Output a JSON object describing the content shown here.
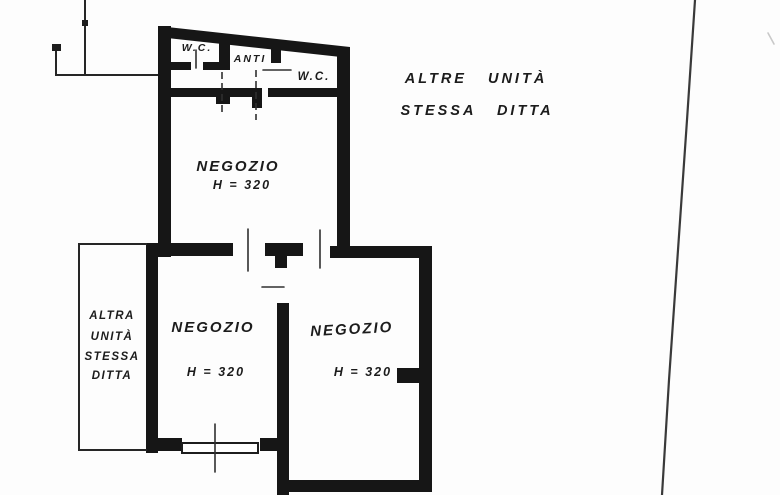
{
  "plan": {
    "paper_color": "#fdfdfd",
    "ink_color": "#161616",
    "rooms": {
      "wc_left": {
        "label": "W.C."
      },
      "anti": {
        "label": "ANTI"
      },
      "wc_right": {
        "label": "W.C."
      },
      "negozio_top": {
        "label": "NEGOZIO",
        "height": "H = 320"
      },
      "negozio_bottom_left": {
        "label": "NEGOZIO",
        "height": "H = 320"
      },
      "negozio_bottom_right": {
        "label": "NEGOZIO",
        "height": "H = 320"
      }
    },
    "annotations": {
      "adjacent_right": {
        "line1": "ALTRE UNITÀ",
        "line2": "STESSA DITTA"
      },
      "adjacent_left": {
        "line1": "ALTRA",
        "line2": "UNITÀ",
        "line3": "STESSA",
        "line4": "DITTA"
      }
    }
  }
}
